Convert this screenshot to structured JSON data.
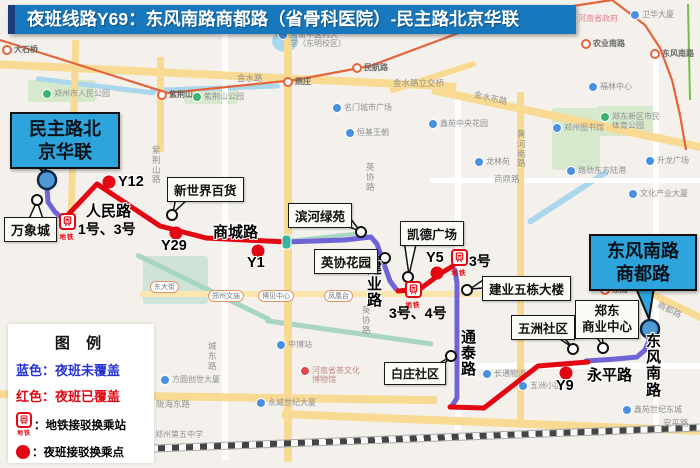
{
  "title": "夜班线路Y69：东风南路商都路（省骨科医院）-民主路北京华联",
  "colors": {
    "covered_red": "#e30613",
    "uncovered_blue": "#6f63d8",
    "terminal_fill": "#4f9ad5",
    "title_bar": "#1878bd",
    "callout_blue": "#2ea4dc"
  },
  "terminal_callouts": [
    {
      "line1": "民主路北",
      "line2": "京华联"
    },
    {
      "line1": "东风南路",
      "line2": "商都路"
    }
  ],
  "poi_callouts": [
    "万象城",
    "新世界百货",
    "滨河绿苑",
    "凯德广场",
    "英协花园",
    "建业五栋大楼",
    "白庄社区",
    "五洲社区"
  ],
  "zhengdong_callout": {
    "line1": "郑东",
    "line2": "商业中心"
  },
  "stops": [
    "Y12",
    "Y29",
    "Y1",
    "Y5",
    "Y9"
  ],
  "metro_stations": [
    "1号、3号",
    "3号、4号",
    "3号"
  ],
  "metro_caption": "地铁",
  "road_labels": [
    "人民路",
    "商城路",
    "建业路",
    "通泰路",
    "永平路",
    "东风南路"
  ],
  "legend": {
    "title": "图 例",
    "blue_label": "蓝色：夜班未覆盖",
    "red_label": "红色：夜班已覆盖",
    "metro_label": "：地铁接驳换乘站",
    "stop_label": "：夜班接驳换乘点"
  },
  "basemap": {
    "stations": [
      "大石桥",
      "紫荆山",
      "燕庄",
      "民航路",
      "农业南路",
      "东风南路",
      "东周"
    ],
    "roads": [
      "金水路",
      "金水路立交桥",
      "金水东路",
      "黄河南路",
      "紫荆山路",
      "英协路",
      "城东路",
      "陇海东路",
      "安平路",
      "商都路",
      "商鼎路"
    ],
    "pois": [
      "郑州市人民公园",
      "紫荆山公园",
      "河南中医药大学（东明校区）",
      "河南省政府",
      "卫华大厦",
      "福林中心",
      "郑东新区市民体育公园",
      "郑州图书馆",
      "升龙广场",
      "文化产业大厦",
      "路劲东方陆港",
      "龙林苑",
      "鑫苑中央花园",
      "名门城市广场",
      "恒基王朝",
      "长通物流",
      "五洲小区",
      "鑫苑世纪东城",
      "中博站",
      "永威世纪大厦",
      "方圆创世大厦",
      "河南省茶文化博物馆",
      "郑州第五中学"
    ],
    "brt": [
      "东大街",
      "郑州文庙",
      "博见中心",
      "凤凰台"
    ]
  }
}
